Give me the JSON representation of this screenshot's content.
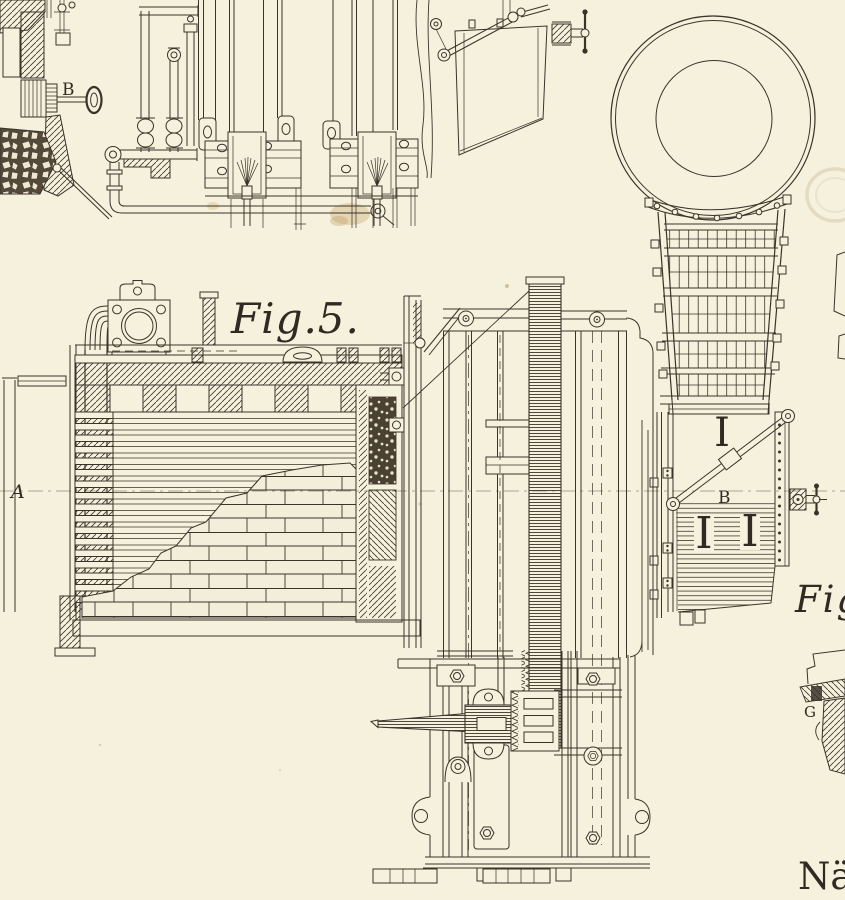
{
  "plate": {
    "paper_color": "#f6f1dd",
    "ink_color": "#3a332a",
    "stain_color": "#c9a96e"
  },
  "labels": {
    "fig5": "Fig.5.",
    "fig_right": "Fig.",
    "part_a": "A",
    "key_b": "B",
    "panel_b": "B",
    "part_g": "G",
    "caption_fragment": "Näg",
    "duct_stencil": "I",
    "panel_stencil_left": "I",
    "panel_stencil_right": "I"
  }
}
